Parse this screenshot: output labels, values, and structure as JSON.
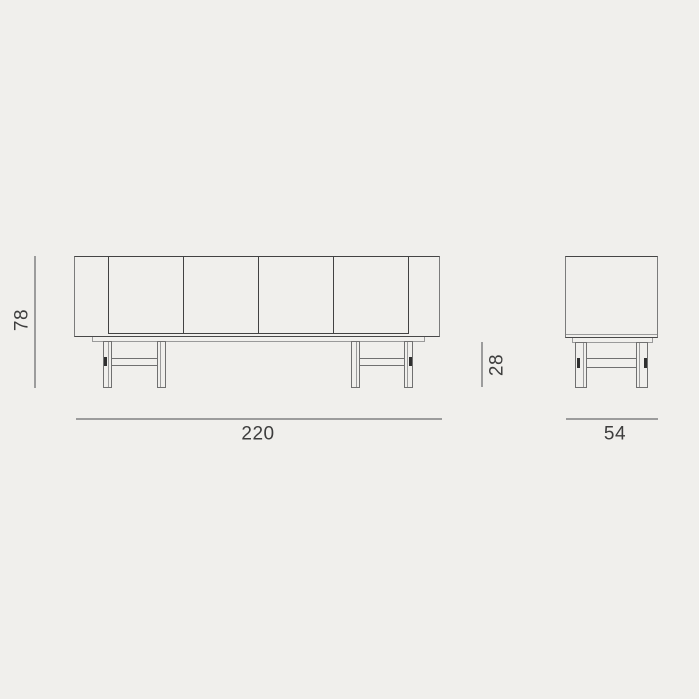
{
  "meta": {
    "kind": "sideboard-dimension-drawing",
    "views": [
      "front",
      "side"
    ],
    "door_count": 4
  },
  "dims": {
    "height": "78",
    "width": "220",
    "leg_height": "28",
    "depth": "54"
  },
  "colors": {
    "background": "#f0efec",
    "outline_dark": "#424242",
    "outline_medium": "#707070",
    "outline_light": "#9a9a9a",
    "dimension_line": "#9c9c9c",
    "label_text": "#3d3d3d",
    "joint_mark": "#2f2f2f"
  }
}
